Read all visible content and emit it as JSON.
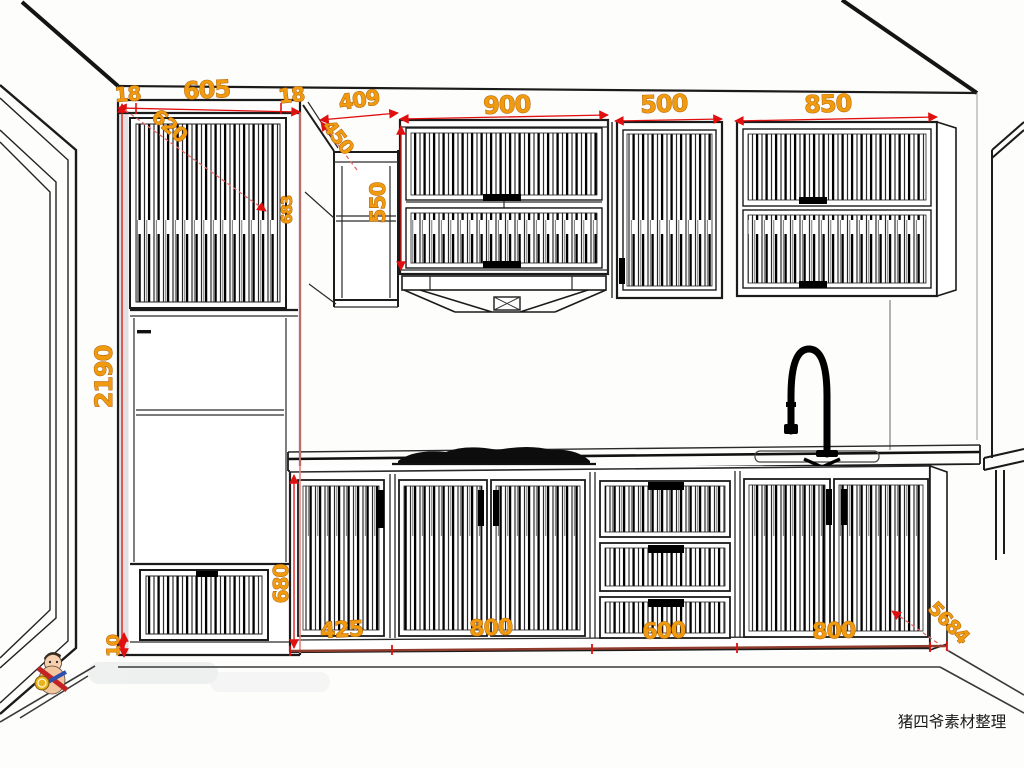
{
  "drawing": {
    "type": "kitchen-cabinet-elevation",
    "dims": {
      "frame18a": "18",
      "door605": "605",
      "frame18b": "18",
      "diag620": "620",
      "corner409": "409",
      "diag450": "450",
      "wall900": "900",
      "wall500": "500",
      "wall850": "850",
      "h550": "550",
      "h683": "683",
      "h2190": "2190",
      "h680": "680",
      "toe10": "10",
      "base425": "425",
      "base800a": "800",
      "base600": "600",
      "base800b": "800",
      "diag5684": "5684"
    }
  },
  "colors": {
    "dimension_text": "#f09a10",
    "dimension_line": "#e01010",
    "accent_pink": "#e8837f",
    "ink": "#1b1b1b",
    "background": "#fdfdfc"
  },
  "caption": {
    "text": "猪四爷素材整理"
  }
}
